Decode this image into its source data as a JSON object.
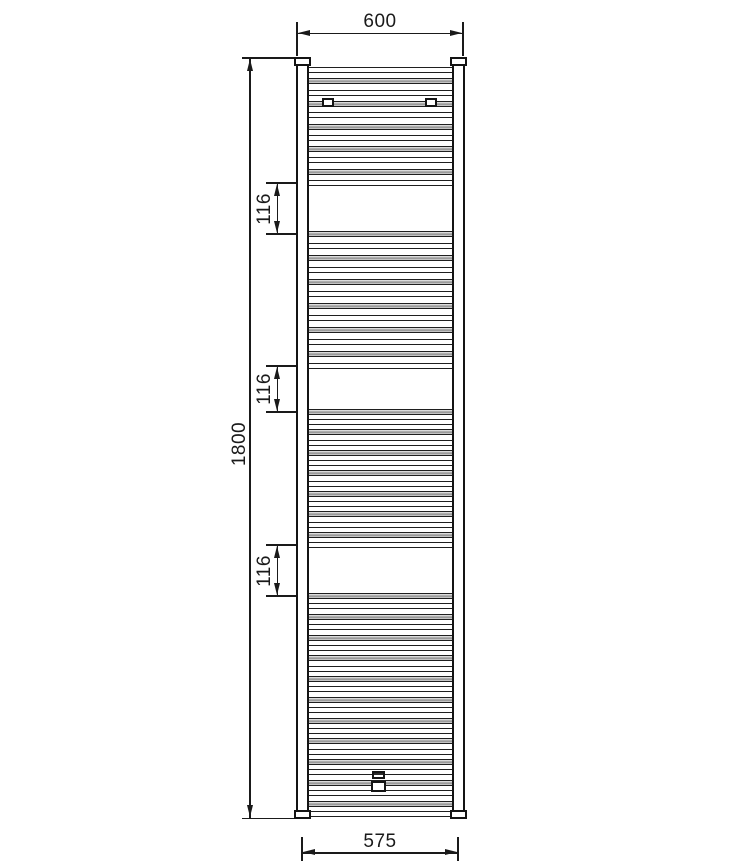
{
  "drawing": {
    "subject": "ladder-towel-radiator-front-view",
    "units": "mm",
    "dimensions": {
      "overall_width": "600",
      "overall_height": "1800",
      "hook_gaps": [
        "116",
        "116",
        "116"
      ],
      "bottom_pipe_centres": "575"
    },
    "colors": {
      "line": "#1a1a1a",
      "background": "#ffffff",
      "rung_shade": "#8e8e8e"
    },
    "geometry": {
      "rung_span": {
        "left": 306,
        "width": 149
      },
      "rung_groups": [
        {
          "count": 11,
          "first_center": 70,
          "last_center": 183
        },
        {
          "count": 12,
          "first_center": 234,
          "last_center": 366
        },
        {
          "count": 14,
          "first_center": 412,
          "last_center": 545
        },
        {
          "count": 22,
          "first_center": 596,
          "last_center": 814
        }
      ]
    }
  }
}
